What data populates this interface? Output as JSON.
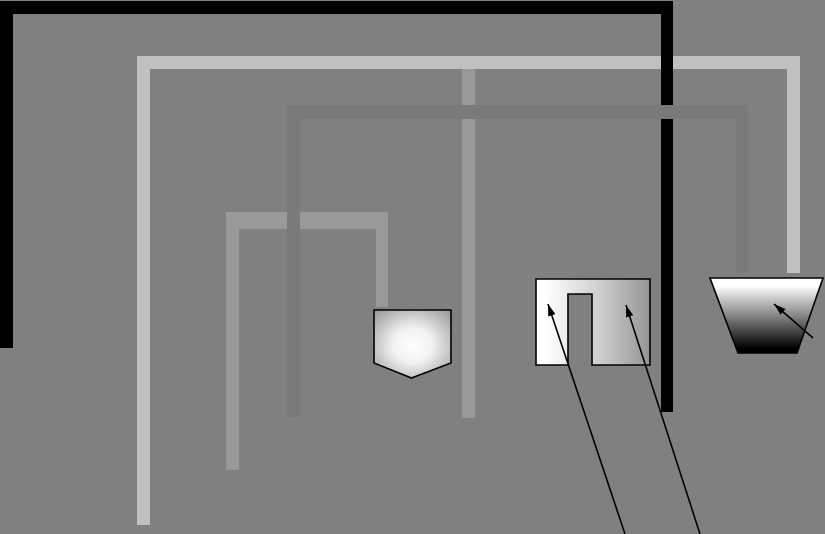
{
  "scene": {
    "width": 825,
    "height": 534,
    "background_color": "#808080",
    "description": "abstract maze-like diagram of nested corner walls with three gradient-filled shapes annotated by arrows",
    "colors": {
      "background": "#808080",
      "black_wall": "#000000",
      "light_gray_wall": "#c0c0c0",
      "medium_gray_wall": "#999999",
      "dark_gray_wall": "#7a7a7a",
      "shape_border": "#000000",
      "arrow": "#000000"
    },
    "walls": [
      {
        "name": "light-gray-wall",
        "color": "#c0c0c0",
        "rects": [
          [
            137,
            56,
            663,
            13
          ],
          [
            137,
            56,
            13,
            469
          ],
          [
            787,
            56,
            13,
            217
          ]
        ]
      },
      {
        "name": "medium-gray-wall",
        "color": "#999999",
        "rects": [
          [
            462,
            69,
            13,
            349
          ],
          [
            226,
            212,
            162,
            17
          ],
          [
            226,
            212,
            13,
            258
          ],
          [
            376,
            212,
            12,
            95
          ]
        ]
      },
      {
        "name": "black-wall",
        "color": "#000000",
        "rects": [
          [
            0,
            1,
            673,
            13
          ],
          [
            0,
            1,
            13,
            347
          ],
          [
            661,
            14,
            12,
            398
          ]
        ]
      },
      {
        "name": "dark-gray-wall",
        "color": "#7a7a7a",
        "rects": [
          [
            287,
            105,
            461,
            14
          ],
          [
            287,
            105,
            13,
            312
          ],
          [
            736,
            105,
            12,
            168
          ]
        ]
      }
    ],
    "gradients": [
      {
        "id": "pentagon-gradient",
        "type": "radial",
        "cx": "50%",
        "cy": "52%",
        "r": "72%",
        "stops": [
          {
            "offset": "0%",
            "color": "#ffffff"
          },
          {
            "offset": "35%",
            "color": "#f2f2f2"
          },
          {
            "offset": "100%",
            "color": "#949494"
          }
        ]
      },
      {
        "id": "staple-gradient",
        "type": "linear",
        "x1": "0%",
        "y1": "0%",
        "x2": "100%",
        "y2": "0%",
        "stops": [
          {
            "offset": "8%",
            "color": "#ffffff"
          },
          {
            "offset": "55%",
            "color": "#cfcfcf"
          },
          {
            "offset": "100%",
            "color": "#959595"
          }
        ]
      },
      {
        "id": "trapezoid-gradient",
        "type": "linear",
        "x1": "0%",
        "y1": "0%",
        "x2": "0%",
        "y2": "100%",
        "stops": [
          {
            "offset": "10%",
            "color": "#ffffff"
          },
          {
            "offset": "94%",
            "color": "#000000"
          }
        ]
      }
    ],
    "shapes": [
      {
        "name": "pentagon-shape",
        "points": "374,310 451,310 451,363 411.5,378 374,363",
        "fill": "pentagon-gradient",
        "stroke": "#000000",
        "stroke_width": 1.6
      },
      {
        "name": "staple-shape",
        "points": "536,279 650,279 650,365 592,365 592,294 568,294 568,365 536,365",
        "fill": "staple-gradient",
        "stroke": "#000000",
        "stroke_width": 1.6
      },
      {
        "name": "trapezoid-shape",
        "points": "710,278 823,278 797,353 738,353",
        "fill": "trapezoid-gradient",
        "stroke": "#000000",
        "stroke_width": 1.6
      }
    ],
    "arrows": [
      {
        "name": "callout-arrow-staple-left",
        "x1": 625,
        "y1": 534,
        "x2": 548,
        "y2": 304
      },
      {
        "name": "callout-arrow-staple-right",
        "x1": 700,
        "y1": 534,
        "x2": 626,
        "y2": 305
      },
      {
        "name": "callout-arrow-trapezoid",
        "x1": 813,
        "y1": 338,
        "x2": 774,
        "y2": 304
      }
    ],
    "arrow_style": {
      "stroke_width": 1.6,
      "head_length": 12,
      "head_width": 7.5
    }
  }
}
